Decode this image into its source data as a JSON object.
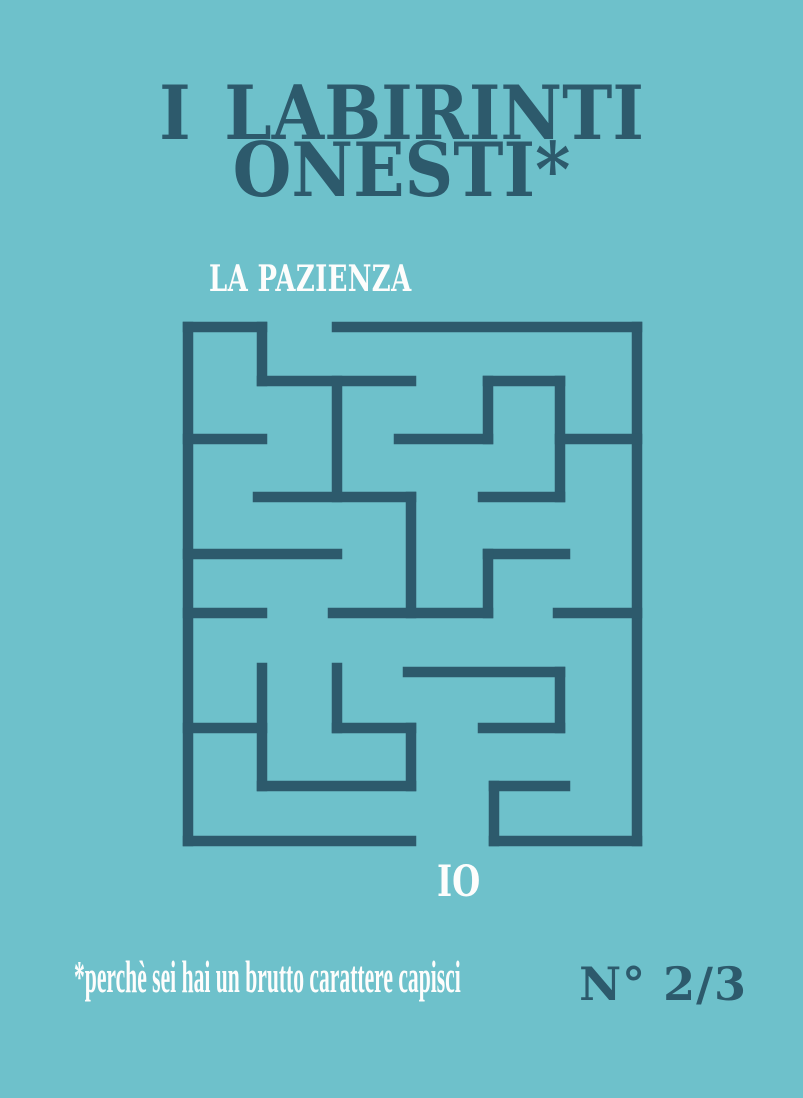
{
  "poster": {
    "background_color": "#6ec1cb",
    "ink_color": "#2d5a6c",
    "white_color": "#fdfdfc"
  },
  "title": {
    "line1": "I LABIRINTI",
    "line2": "ONESTI*"
  },
  "subtitle": "LA PAZIENZA",
  "maze_number": "IO",
  "footnote": "*perchè sei hai un brutto carattere capisci",
  "edition": "N° 2/3",
  "maze": {
    "stroke_width": 10.5,
    "segments": [
      [
        188,
        327,
        188,
        841
      ],
      [
        188,
        841,
        411,
        841
      ],
      [
        494,
        841,
        637,
        841
      ],
      [
        637,
        327,
        637,
        841
      ],
      [
        188,
        327,
        262,
        327
      ],
      [
        337,
        327,
        637,
        327
      ],
      [
        262,
        327,
        262,
        381
      ],
      [
        262,
        381,
        411,
        381
      ],
      [
        337,
        381,
        337,
        497
      ],
      [
        188,
        439,
        262,
        439
      ],
      [
        258,
        497,
        411,
        497
      ],
      [
        411,
        497,
        411,
        613
      ],
      [
        399,
        439,
        488,
        439
      ],
      [
        488,
        381,
        488,
        439
      ],
      [
        488,
        381,
        560,
        381
      ],
      [
        560,
        381,
        560,
        497
      ],
      [
        483,
        497,
        560,
        497
      ],
      [
        560,
        439,
        637,
        439
      ],
      [
        188,
        554,
        337,
        554
      ],
      [
        488,
        554,
        565,
        554
      ],
      [
        488,
        554,
        488,
        613
      ],
      [
        333,
        613,
        488,
        613
      ],
      [
        188,
        613,
        262,
        613
      ],
      [
        558,
        613,
        637,
        613
      ],
      [
        408,
        672,
        560,
        672
      ],
      [
        560,
        672,
        560,
        728
      ],
      [
        483,
        728,
        560,
        728
      ],
      [
        188,
        728,
        262,
        728
      ],
      [
        262,
        668,
        262,
        786
      ],
      [
        337,
        668,
        337,
        728
      ],
      [
        337,
        728,
        411,
        728
      ],
      [
        411,
        728,
        411,
        786
      ],
      [
        262,
        786,
        411,
        786
      ],
      [
        494,
        786,
        565,
        786
      ],
      [
        494,
        786,
        494,
        841
      ]
    ]
  }
}
